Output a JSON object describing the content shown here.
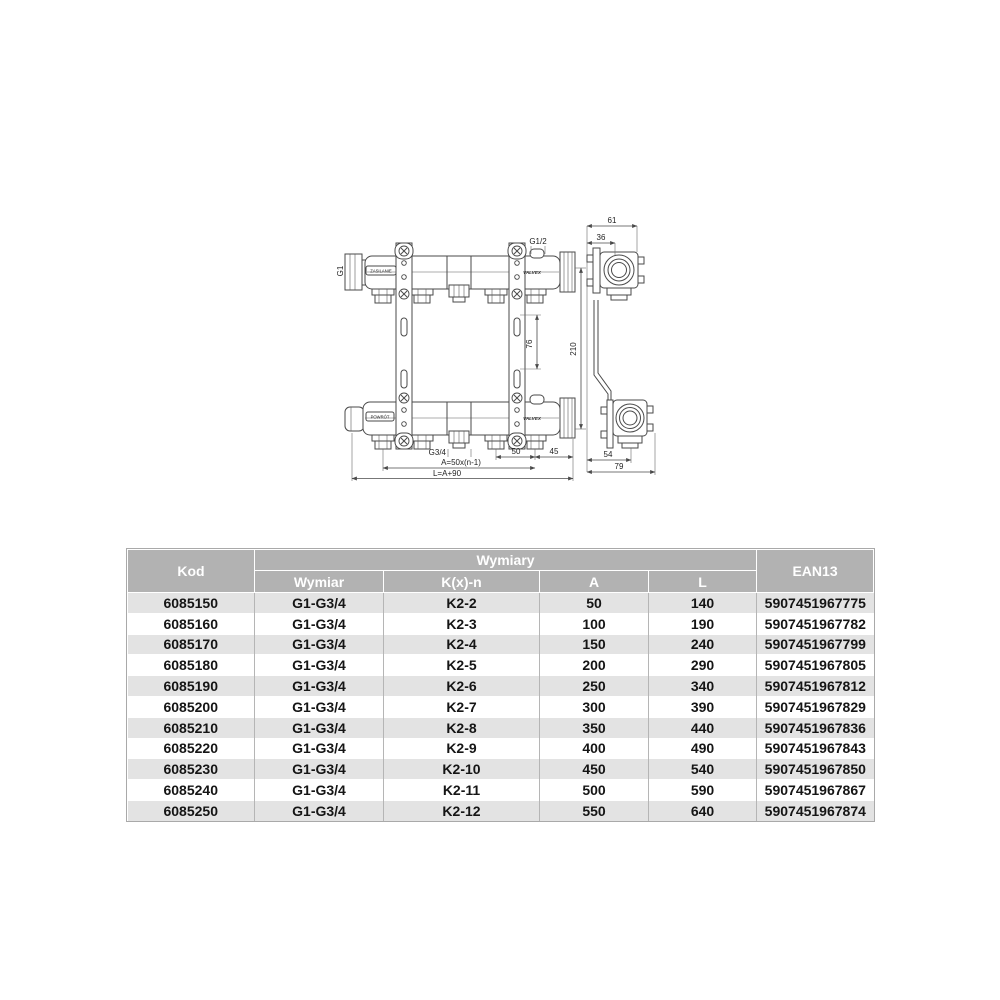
{
  "colors": {
    "page_bg": "#ffffff",
    "header_bg": "#b2b2b2",
    "header_text": "#ffffff",
    "row_alt_bg": "#e3e3e3",
    "row_bg": "#ffffff",
    "drawing_line": "#4a4a4a"
  },
  "drawing": {
    "labels": {
      "g1": "G1",
      "g1_2": "G1/2",
      "g3_4": "G3/4",
      "supply": "ZASILANIE",
      "return_": "POWRÓT",
      "brand_top": "VALVEX",
      "brand_bottom": "VALVEX",
      "dim_76": "76",
      "dim_210": "210",
      "dim_50": "50",
      "dim_45": "45",
      "dim_a": "A=50x(n-1)",
      "dim_l": "L=A+90",
      "dim_61": "61",
      "dim_36": "36",
      "dim_54": "54",
      "dim_79": "79"
    }
  },
  "table": {
    "header": {
      "kod": "Kod",
      "wymiary": "Wymiary",
      "wymiar": "Wymiar",
      "kxn": "K(x)-n",
      "a": "A",
      "l": "L",
      "ean13": "EAN13"
    },
    "rows": [
      {
        "kod": "6085150",
        "wymiar": "G1-G3/4",
        "kxn": "K2-2",
        "a": "50",
        "l": "140",
        "ean": "5907451967775"
      },
      {
        "kod": "6085160",
        "wymiar": "G1-G3/4",
        "kxn": "K2-3",
        "a": "100",
        "l": "190",
        "ean": "5907451967782"
      },
      {
        "kod": "6085170",
        "wymiar": "G1-G3/4",
        "kxn": "K2-4",
        "a": "150",
        "l": "240",
        "ean": "5907451967799"
      },
      {
        "kod": "6085180",
        "wymiar": "G1-G3/4",
        "kxn": "K2-5",
        "a": "200",
        "l": "290",
        "ean": "5907451967805"
      },
      {
        "kod": "6085190",
        "wymiar": "G1-G3/4",
        "kxn": "K2-6",
        "a": "250",
        "l": "340",
        "ean": "5907451967812"
      },
      {
        "kod": "6085200",
        "wymiar": "G1-G3/4",
        "kxn": "K2-7",
        "a": "300",
        "l": "390",
        "ean": "5907451967829"
      },
      {
        "kod": "6085210",
        "wymiar": "G1-G3/4",
        "kxn": "K2-8",
        "a": "350",
        "l": "440",
        "ean": "5907451967836"
      },
      {
        "kod": "6085220",
        "wymiar": "G1-G3/4",
        "kxn": "K2-9",
        "a": "400",
        "l": "490",
        "ean": "5907451967843"
      },
      {
        "kod": "6085230",
        "wymiar": "G1-G3/4",
        "kxn": "K2-10",
        "a": "450",
        "l": "540",
        "ean": "5907451967850"
      },
      {
        "kod": "6085240",
        "wymiar": "G1-G3/4",
        "kxn": "K2-11",
        "a": "500",
        "l": "590",
        "ean": "5907451967867"
      },
      {
        "kod": "6085250",
        "wymiar": "G1-G3/4",
        "kxn": "K2-12",
        "a": "550",
        "l": "640",
        "ean": "5907451967874"
      }
    ]
  }
}
